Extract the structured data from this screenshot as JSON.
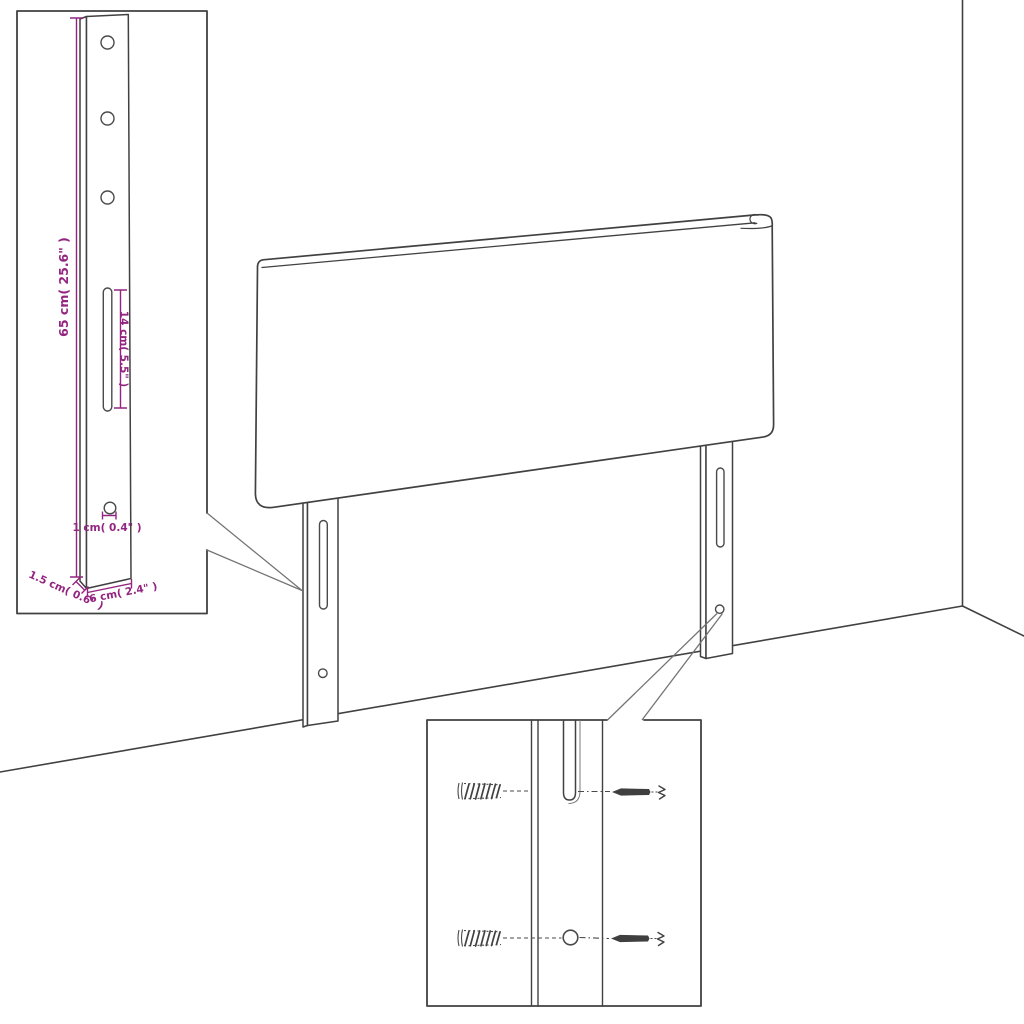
{
  "diagram": {
    "title": "Headboard wall-mounting instruction drawing",
    "background": "#ffffff",
    "colors": {
      "line": "#414141",
      "dimension": "#932480",
      "callout": "#747474"
    },
    "bracket_inset": {
      "dims": {
        "height": "65 cm( 25.6\" )",
        "slot_length": "14 cm( 5.5\" )",
        "hole_diameter": "1 cm( 0.4\" )",
        "thickness": "1.5 cm( 0.6\" )",
        "width": "6 cm( 2.4\" )"
      }
    },
    "hardware_inset": {
      "items": [
        "wall-plug",
        "screw"
      ]
    },
    "parts": [
      "headboard-panel",
      "left-mounting-leg",
      "right-mounting-leg",
      "room-corner",
      "floor-line"
    ]
  }
}
